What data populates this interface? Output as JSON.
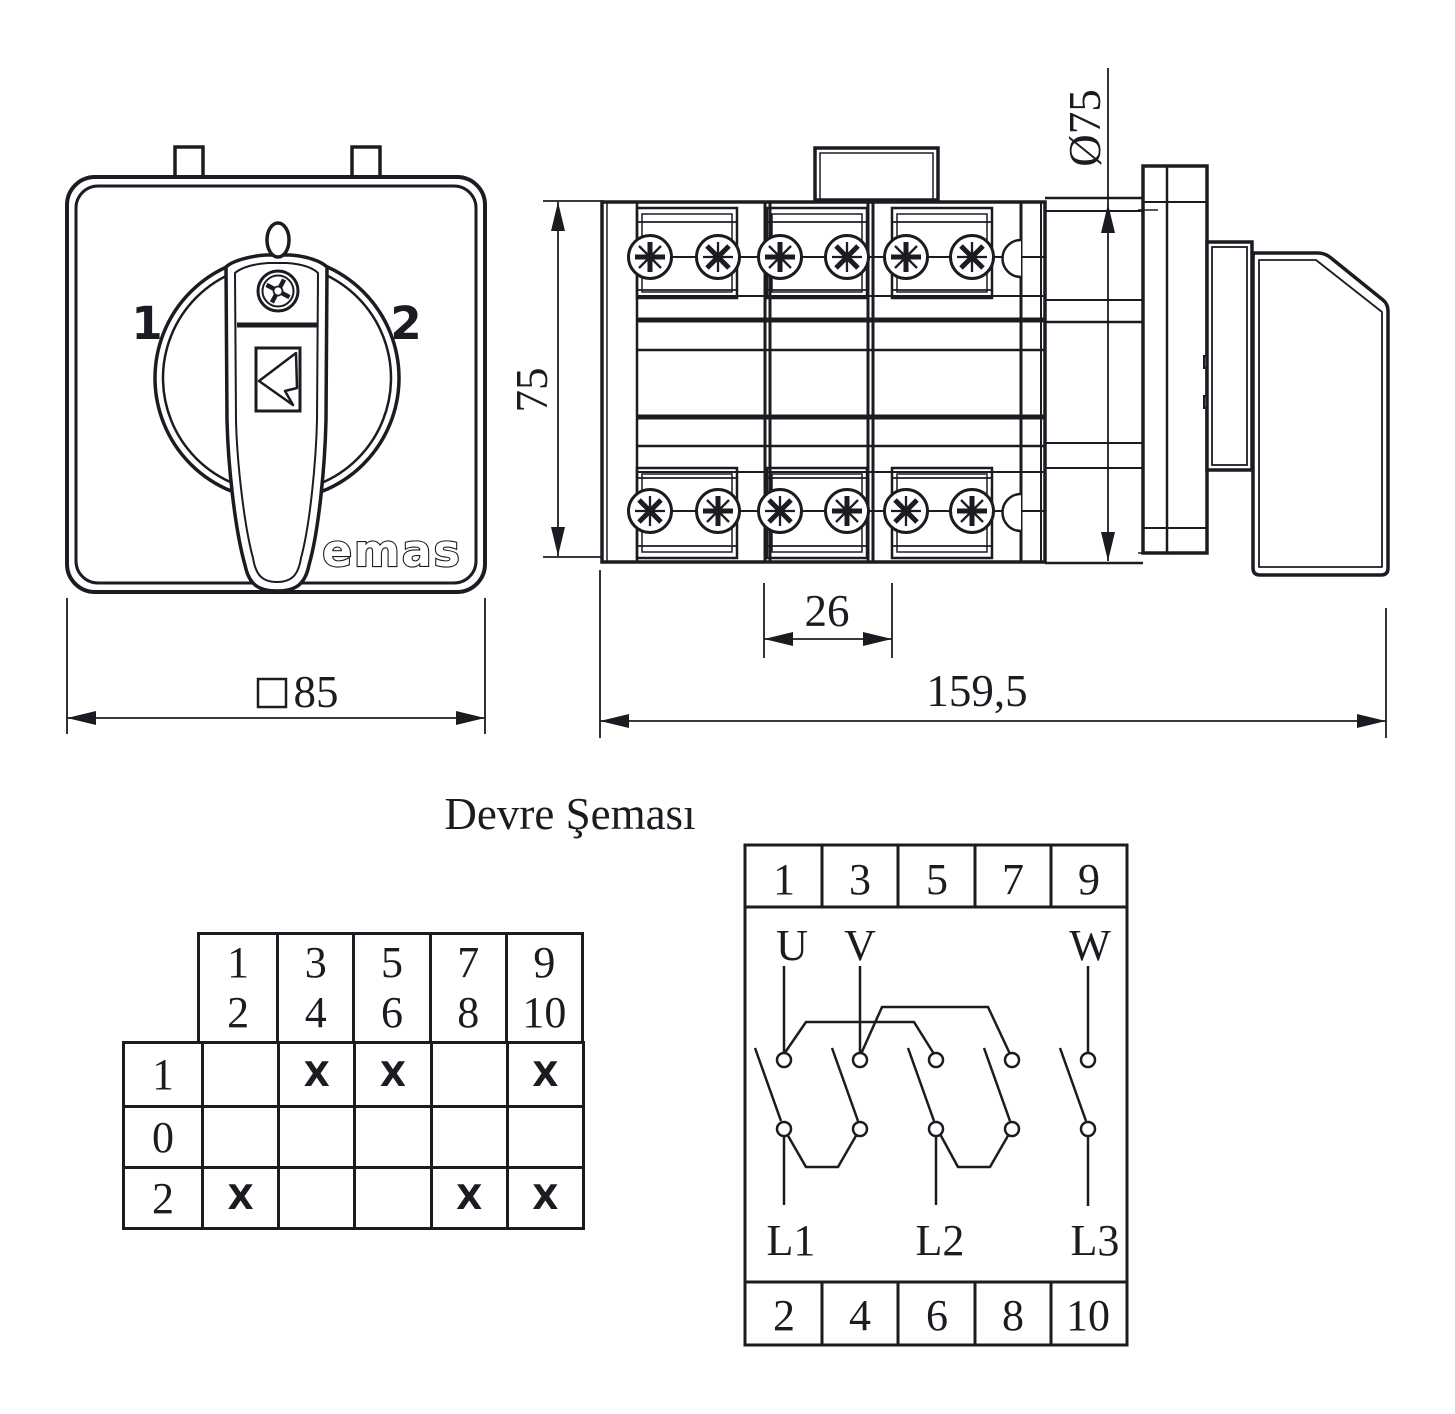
{
  "title": "Devre Şeması",
  "front_view": {
    "pos_left": "1",
    "pos_right": "2",
    "brand": "emas",
    "dim_width": "85"
  },
  "side_view": {
    "dim_height": "75",
    "dim_diameter": "Ø75",
    "dim_pitch": "26",
    "dim_length": "159,5"
  },
  "contact_table": {
    "headers": [
      [
        "1",
        "2"
      ],
      [
        "3",
        "4"
      ],
      [
        "5",
        "6"
      ],
      [
        "7",
        "8"
      ],
      [
        "9",
        "10"
      ]
    ],
    "rows": [
      {
        "label": "1",
        "cells": [
          "",
          "X",
          "X",
          "",
          "X"
        ]
      },
      {
        "label": "0",
        "cells": [
          "",
          "",
          "",
          "",
          ""
        ]
      },
      {
        "label": "2",
        "cells": [
          "X",
          "",
          "",
          "X",
          "X"
        ]
      }
    ]
  },
  "circuit": {
    "top": [
      "1",
      "3",
      "5",
      "7",
      "9"
    ],
    "bottom": [
      "2",
      "4",
      "6",
      "8",
      "10"
    ],
    "phases": [
      "U",
      "V",
      "W"
    ],
    "lines": [
      "L1",
      "L2",
      "L3"
    ]
  }
}
